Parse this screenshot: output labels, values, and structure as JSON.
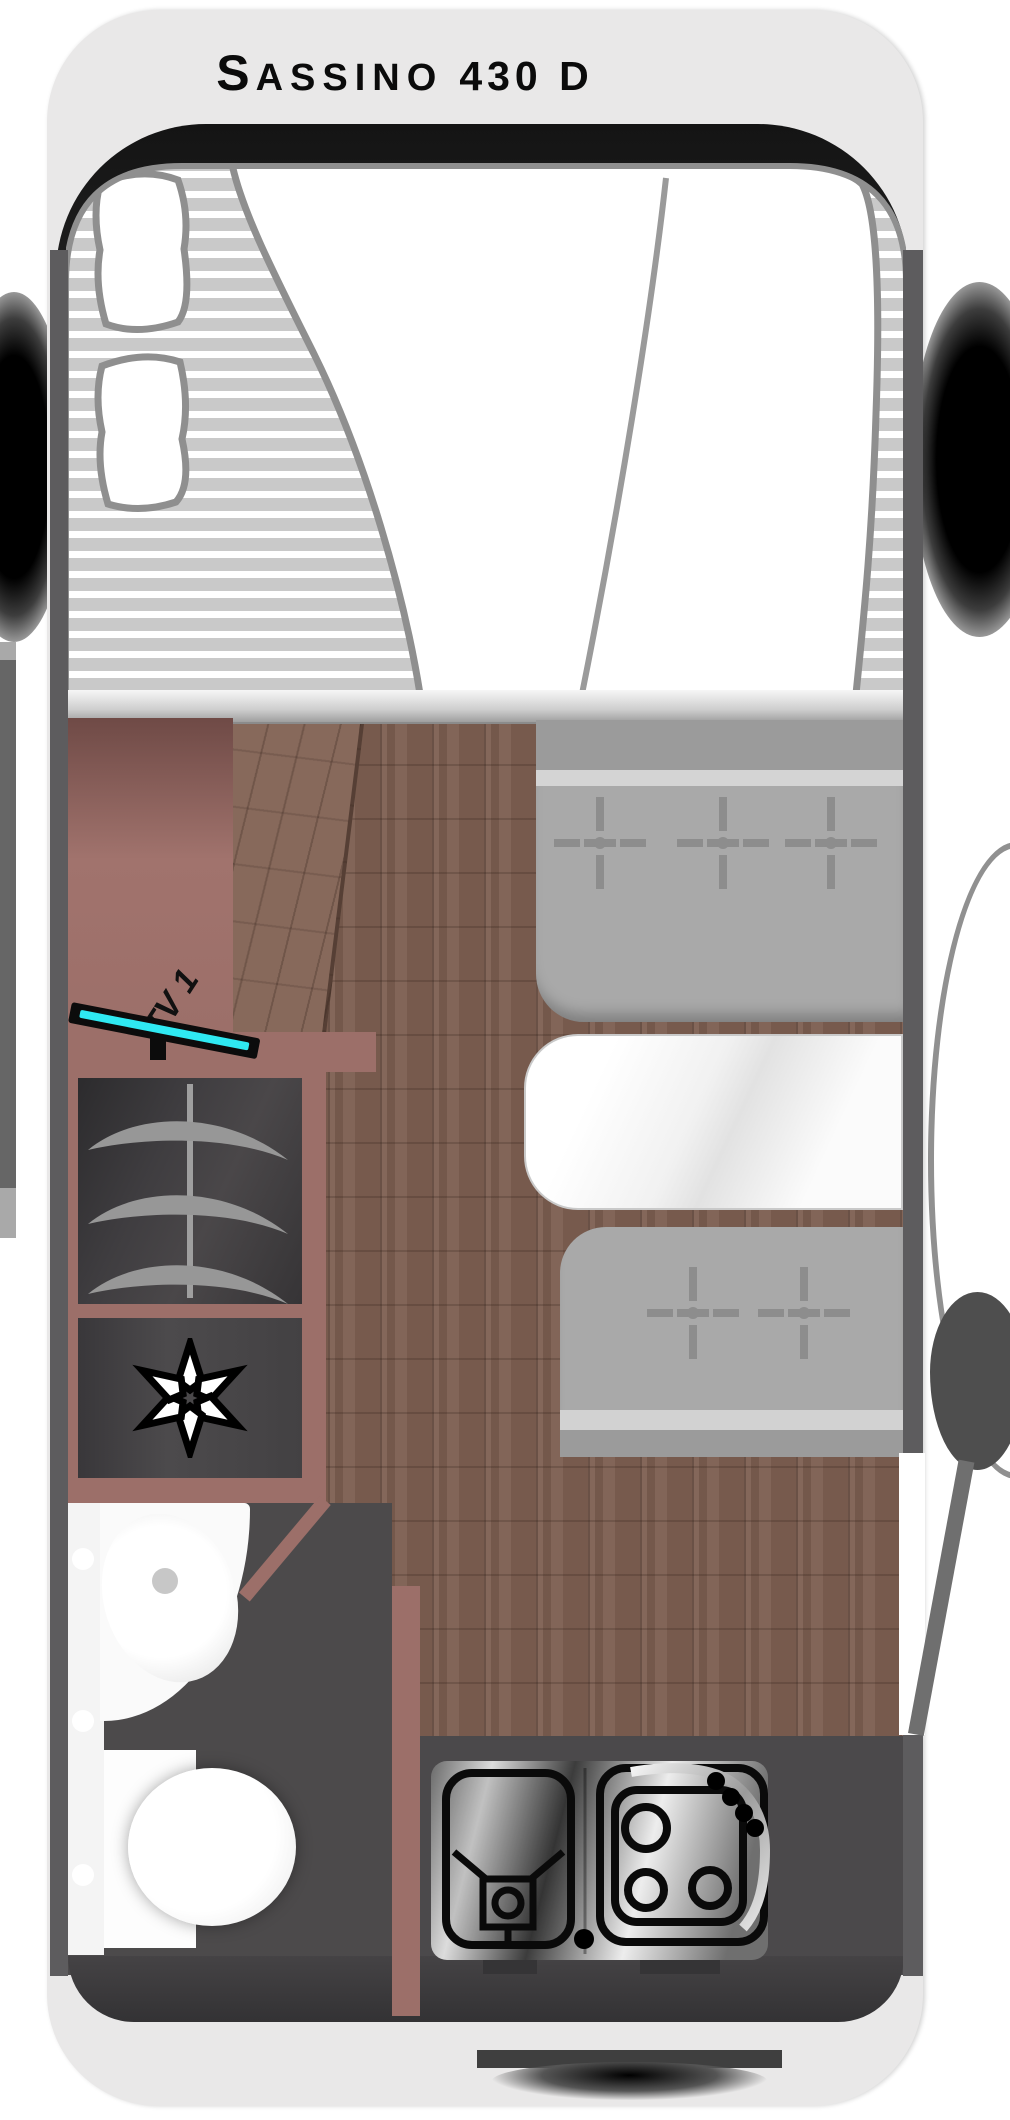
{
  "vehicle": {
    "title_brand_initial": "S",
    "title_brand_rest": "ASSINO",
    "title_variant": "430 D"
  },
  "labels": {
    "tv_unit": "TV 1"
  },
  "colors": {
    "body_shell": "#e9e8e8",
    "cab_frame": "#1e1e1e",
    "interior_wall": "#5d5c5e",
    "furniture_mauve": "#9c6f69",
    "wood_floor": "#7d5f51",
    "bench_upholstery": "#a9a9a9",
    "table_top": "#f5f5f5",
    "wet_room_floor": "#4c4a4b",
    "kitchen_counter_dark": "#4b494b",
    "tv_screen_cyan": "#2fe9f2",
    "mattress_stripe": "#c9c9c9"
  },
  "symbols": {
    "front_bench_seatbelt_marks": 3,
    "rear_bench_seatbelt_marks": 2,
    "wardrobe_hangers": 3,
    "hob_burners": 3,
    "fridge_symbol": "six-point-asterisk"
  }
}
